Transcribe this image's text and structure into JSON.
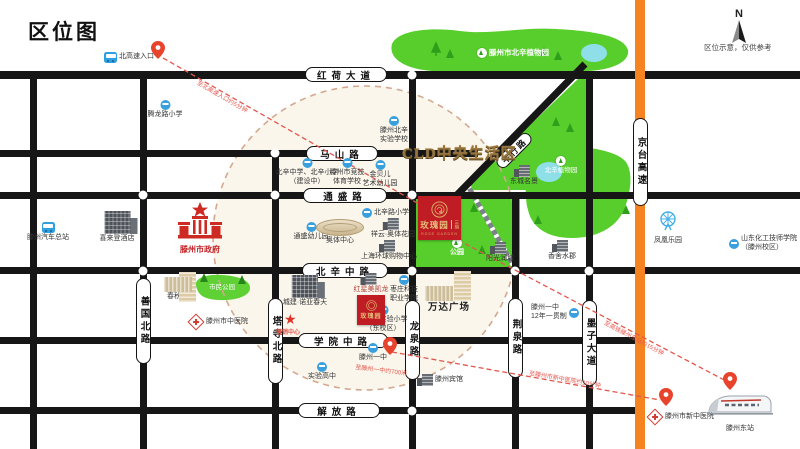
{
  "title": "区位图",
  "compass": {
    "n": "N",
    "note": "区位示意，仅供参考"
  },
  "badge": "CLD中央生活区",
  "roads": {
    "honghe": "红荷大道",
    "mashan": "马山路",
    "tongsheng": "通盛路",
    "beixinzhong": "北辛中路",
    "xueyuanzhong": "学院中路",
    "jiefang": "解放路",
    "shanguobei": "善国北路",
    "tasibei": "塔寺北路",
    "longquan": "龙泉路",
    "jingquan": "荆泉路",
    "mozidadao": "墨子大道",
    "jingtai": "京台高速",
    "pingxing": "平行路"
  },
  "project": {
    "name": "玫瑰园",
    "phase": "三期",
    "sub_en": "ROSE GARDEN",
    "south_name": "玫瑰园",
    "marker_label": "营销中心"
  },
  "landmarks": [
    {
      "label": "北高速入口"
    },
    {
      "label": "腾龙路小学"
    },
    {
      "label": "滕州市北辛植物园"
    },
    {
      "label": "滕州北辛\n实验学校"
    },
    {
      "label": "北辛中学、北辛小学\n（建设中）"
    },
    {
      "label": "滕州市竞技\n体育学校"
    },
    {
      "label": "金贝儿\n艺术幼儿园"
    },
    {
      "label": "东城名景"
    },
    {
      "label": "北辛路小学"
    },
    {
      "label": "通盛幼儿园"
    },
    {
      "label": "奥体中心"
    },
    {
      "label": "祥云·奥体花园"
    },
    {
      "label": "上海环球购物中心"
    },
    {
      "label": "公园"
    },
    {
      "label": "阳光润城"
    },
    {
      "label": "香舍水郡"
    },
    {
      "label": "北辛植物园"
    },
    {
      "label": "凤凰乐园"
    },
    {
      "label": "山东化工技师学院\n（滕州校区）"
    },
    {
      "label": "滕州汽车总站"
    },
    {
      "label": "喜来登酒店"
    },
    {
      "label": "滕州市政府"
    },
    {
      "label": "春秋广场"
    },
    {
      "label": "市民公园"
    },
    {
      "label": "滕州市中医院"
    },
    {
      "label": "城建·诺亚春天"
    },
    {
      "label": "红星美凯龙"
    },
    {
      "label": "枣庄科技\n职业学院"
    },
    {
      "label": "滕州市实验小学\n（东校区）"
    },
    {
      "label": "滕州一中"
    },
    {
      "label": "实验高中"
    },
    {
      "label": "万达广场"
    },
    {
      "label": "滕州宾馆"
    },
    {
      "label": "滕州一中\n12年一贯制"
    },
    {
      "label": "滕州市新中医院"
    },
    {
      "label": "滕州东站"
    }
  ],
  "routes": [
    {
      "text": "至北高速入口约5分钟"
    },
    {
      "text": "至高铁滕州东站约15分钟"
    },
    {
      "text": "至滕州市新中医院约10分钟"
    },
    {
      "text": "至滕州一中约700米"
    }
  ],
  "colors": {
    "road": "#161616",
    "green": "#57ce2b",
    "lake": "#8fdfe9",
    "highway_orange": "#f5831f",
    "project_red": "#bf1d23",
    "gold": "#d9a95e",
    "route_red": "#e2574d"
  }
}
